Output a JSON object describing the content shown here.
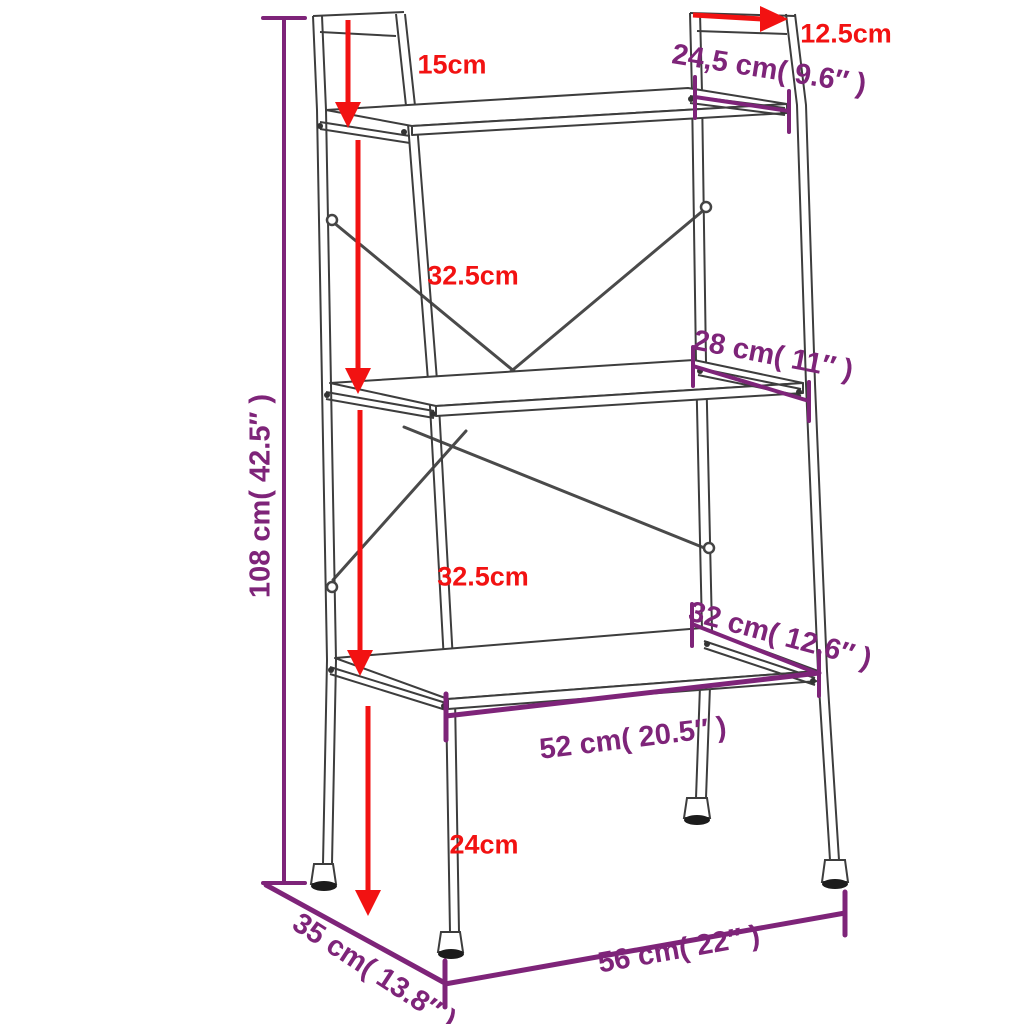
{
  "diagram": {
    "type": "product-dimension-diagram",
    "subject": "3-tier ladder shelving unit",
    "background": "#ffffff",
    "colors": {
      "red_dimension": "#f21212",
      "purple_dimension": "#7e2479",
      "frame_line": "#3d3d3d"
    },
    "dimensions": {
      "top_frame_height": "15cm",
      "top_rail_length": "12.5cm",
      "top_shelf_depth": "24,5 cm( 9.6″ )",
      "upper_tier_spacing": "32.5cm",
      "middle_shelf_depth": "28 cm( 11″ )",
      "total_height": "108 cm( 42.5″ )",
      "lower_tier_spacing": "32.5cm",
      "bottom_shelf_depth": "32 cm( 12.6″ )",
      "bottom_shelf_width": "52 cm( 20.5″ )",
      "leg_height": "24cm",
      "base_depth": "35 cm( 13.8″ )",
      "base_width": "56 cm( 22″ )"
    }
  }
}
